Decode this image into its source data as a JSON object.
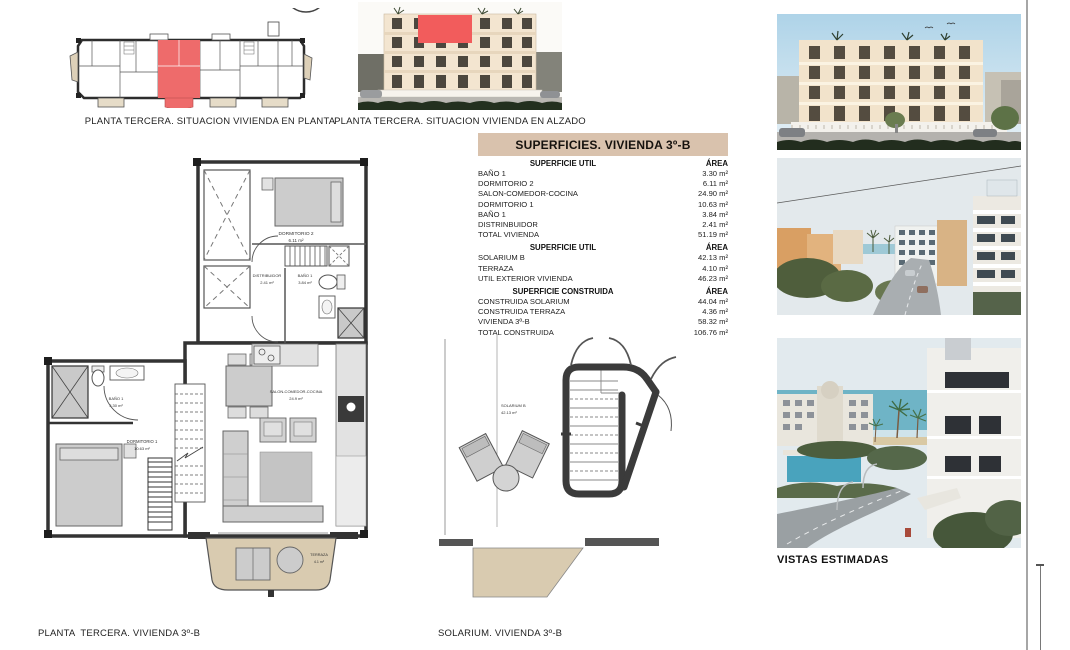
{
  "captions": {
    "situacion_planta": "PLANTA TERCERA. SITUACION VIVIENDA EN PLANTA",
    "situacion_alzado": "PLANTA TERCERA. SITUACION VIVIENDA EN ALZADO",
    "floorplan": "PLANTA  TERCERA. VIVIENDA 3º-B",
    "solarium": "SOLARIUM. VIVIENDA 3º-B",
    "vistas": "VISTAS ESTIMADAS"
  },
  "surface_table": {
    "title": "SUPERFICIES. VIVIENDA 3º-B",
    "sections": [
      {
        "header": "SUPERFICIE UTIL",
        "area_label": "ÁREA",
        "rows": [
          {
            "name": "BAÑO 1",
            "value": "3.30 m²"
          },
          {
            "name": "DORMITORIO 2",
            "value": "6.11 m²"
          },
          {
            "name": "SALON-COMEDOR-COCINA",
            "value": "24.90 m²"
          },
          {
            "name": "DORMITORIO 1",
            "value": "10.63 m²"
          },
          {
            "name": "BAÑO 1",
            "value": "3.84 m²"
          },
          {
            "name": "DISTRINBUIDOR",
            "value": "2.41 m²"
          },
          {
            "name": "TOTAL VIVIENDA",
            "value": "51.19 m²"
          }
        ]
      },
      {
        "header": "SUPERFICIE UTIL",
        "area_label": "ÁREA",
        "rows": [
          {
            "name": "SOLARIUM B",
            "value": "42.13 m²"
          },
          {
            "name": "TERRAZA",
            "value": "4.10 m²"
          },
          {
            "name": "UTIL EXTERIOR VIVIENDA",
            "value": "46.23 m²"
          }
        ]
      },
      {
        "header": "SUPERFICIE CONSTRUIDA",
        "area_label": "ÁREA",
        "rows": [
          {
            "name": "CONSTRUIDA SOLARIUM",
            "value": "44.04 m²"
          },
          {
            "name": "CONSTRUIDA TERRAZA",
            "value": "4.36 m²"
          },
          {
            "name": "VIVIENDA 3º-B",
            "value": "58.32 m²"
          },
          {
            "name": "TOTAL CONSTRUIDA",
            "value": "106.76 m²"
          }
        ]
      }
    ]
  },
  "floorplan_labels": {
    "dorm2_name": "DORMITORIO 2",
    "dorm2_area": "6.11 m²",
    "distrib_name": "DISTRIBUIDOR",
    "distrib_area": "2.41 m²",
    "bano_top_name": "BAÑO 1",
    "bano_top_area": "3.84 m²",
    "bano_bottom_name": "BAÑO 1",
    "bano_bottom_area": "3.30 m²",
    "dorm1_name": "DORMITORIO 1",
    "dorm1_area": "10.63 m²",
    "salon_name": "SALON-COMEDOR-COCINA",
    "salon_area": "24.9 m²",
    "terraza_name": "TERRAZA",
    "terraza_area": "4.1 m²"
  },
  "solarium_labels": {
    "name": "SOLARIUM B",
    "area": "42.13 m²"
  },
  "colors": {
    "highlight_red": "#ee6b6b",
    "table_header_bg": "#d9c2ad",
    "terrace_beige": "#d9cbb0",
    "wall_dark": "#333333"
  }
}
